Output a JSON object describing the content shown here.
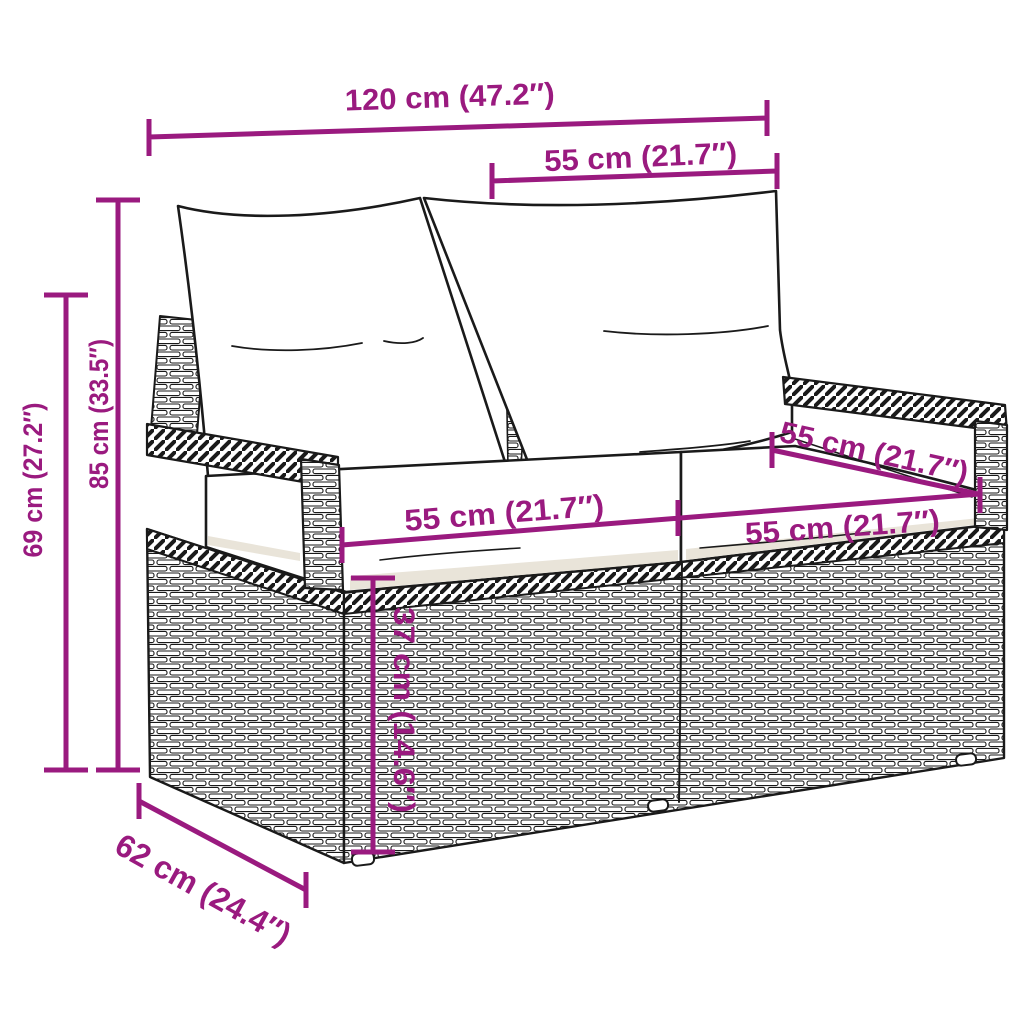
{
  "figure": {
    "kind": "product dimension diagram",
    "subject": "poly rattan 2-seater garden sofa with back and seat cushions",
    "background_color": "#FFFFFF",
    "accent_color": "#9A1A7F",
    "line_art_color": "#1A1A1A"
  },
  "dimensions": {
    "overall_width": "120 cm (47.2″)",
    "backrest_section_width": "55 cm (21.7″)",
    "total_height": "85 cm (33.5″)",
    "armrest_height": "69 cm (27.2″)",
    "seat_depth": "55 cm (21.7″)",
    "seat_width_left": "55 cm (21.7″)",
    "seat_width_right": "55 cm (21.7″)",
    "base_height": "37 cm (14.6″)",
    "overall_depth": "62 cm (24.4″)"
  }
}
